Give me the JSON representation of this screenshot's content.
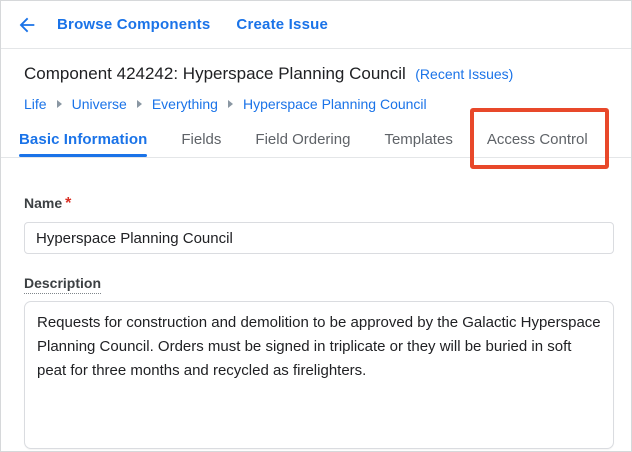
{
  "colors": {
    "accent_blue": "#1a73e8",
    "annotation_red": "#e8482a",
    "required_red": "#d93025"
  },
  "header": {
    "back_icon": "arrow-left",
    "browse_components_label": "Browse Components",
    "create_issue_label": "Create Issue"
  },
  "title": {
    "main": "Component 424242: Hyperspace Planning Council",
    "recent_issues_link": "(Recent Issues)"
  },
  "breadcrumb": {
    "items": [
      {
        "label": "Life"
      },
      {
        "label": "Universe"
      },
      {
        "label": "Everything"
      },
      {
        "label": "Hyperspace Planning Council"
      }
    ]
  },
  "tabs": {
    "items": [
      {
        "label": "Basic Information",
        "active": true,
        "annotated": false
      },
      {
        "label": "Fields",
        "active": false,
        "annotated": false
      },
      {
        "label": "Field Ordering",
        "active": false,
        "annotated": false
      },
      {
        "label": "Templates",
        "active": false,
        "annotated": false
      },
      {
        "label": "Access Control",
        "active": false,
        "annotated": true
      }
    ]
  },
  "form": {
    "name_field": {
      "label": "Name",
      "required_marker": "*",
      "value": "Hyperspace Planning Council"
    },
    "description_field": {
      "label": "Description",
      "value": "Requests for construction and demolition to be approved by the Galactic Hyperspace Planning Council. Orders must be signed in triplicate or they will be buried in soft peat for three months and recycled as firelighters."
    }
  }
}
